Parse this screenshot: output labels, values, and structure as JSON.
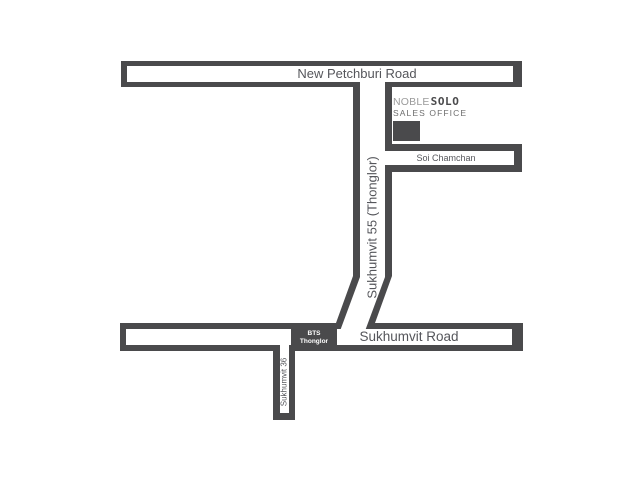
{
  "map": {
    "roads": {
      "new_petchburi": {
        "label": "New Petchburi Road"
      },
      "sukhumvit_55": {
        "label": "Sukhumvit 55 (Thonglor)"
      },
      "soi_chamchan": {
        "label": "Soi Chamchan"
      },
      "sukhumvit_road": {
        "label": "Sukhumvit Road"
      },
      "sukhumvit_36": {
        "label": "Sukhumvit 36"
      }
    },
    "station": {
      "line1": "BTS",
      "line2": "Thonglor"
    },
    "office": {
      "brand_noble": "NOBLE",
      "brand_solo": "SOLO",
      "subtitle": "SALES OFFICE"
    },
    "colors": {
      "background": "#ffffff",
      "road_outline": "#4a4a4c",
      "road_surface": "#ffffff",
      "road_label": "#55565b",
      "brand_noble": "#9b9b9b",
      "brand_solo": "#4a4a4c",
      "subtitle": "#6e6e6e",
      "station_box": "#4a4a4c",
      "station_text": "#ffffff",
      "office_marker": "#4a4a4c"
    }
  }
}
